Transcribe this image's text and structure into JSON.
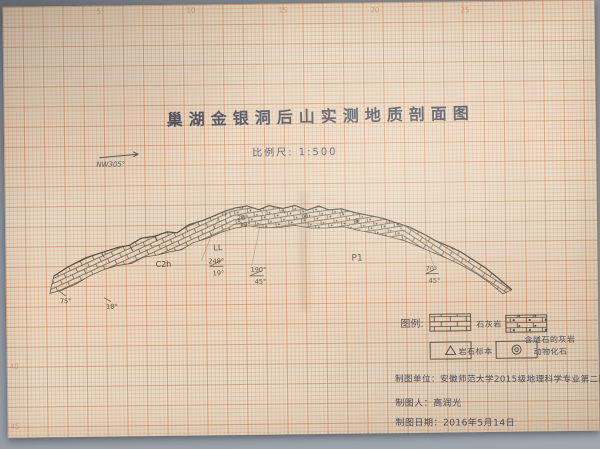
{
  "meta": {
    "description": "Photograph of a hand-drawn measured geological cross-section on orange millimeter grid paper"
  },
  "colors": {
    "desk_gray": "#8c929a",
    "paper_beige": "#e8dac5",
    "grid_orange_major": "#c87244",
    "grid_orange_minor": "#d48a60",
    "pencil": "#5a5348",
    "ink_blue_gray": "#4b5060"
  },
  "title": {
    "text": "巢湖金银洞后山实测地质剖面图"
  },
  "scale": {
    "text": "比例尺: 1:500"
  },
  "north_arrow": {
    "label": "NW305°"
  },
  "ruler": {
    "top": [
      "5",
      "10",
      "15",
      "20",
      "25"
    ],
    "left": [
      "40",
      "45"
    ]
  },
  "section": {
    "strat_labels": [
      {
        "text": "C2h"
      },
      {
        "text": "LL"
      },
      {
        "text": "P1"
      }
    ],
    "dip_annotations": [
      {
        "line1": "26°",
        "line2": "19°"
      },
      {
        "line1": "248°",
        "line2": "19°"
      },
      {
        "line1": "190°",
        "line2": "45°"
      },
      {
        "line1": "70°",
        "line2": "45°"
      },
      {
        "line1": "75°",
        "line2": ""
      },
      {
        "line1": "18°",
        "line2": ""
      }
    ]
  },
  "legend": {
    "heading": "图例:",
    "items": [
      {
        "label": "石灰岩",
        "symbol": "limestone-brick-pattern"
      },
      {
        "label": "含燧石的灰岩",
        "symbol": "chert-nodule-brick-pattern"
      },
      {
        "label": "岩石标本",
        "symbol": "triangle-sample-marker"
      },
      {
        "label": "动物化石",
        "symbol": "fossil-circle-marker"
      }
    ]
  },
  "footer": {
    "unit": "制图单位：安徽师范大学2015级地理科学专业第二队六组",
    "author": "制图人：高润光",
    "date": "制图日期：2016年5月14日"
  }
}
